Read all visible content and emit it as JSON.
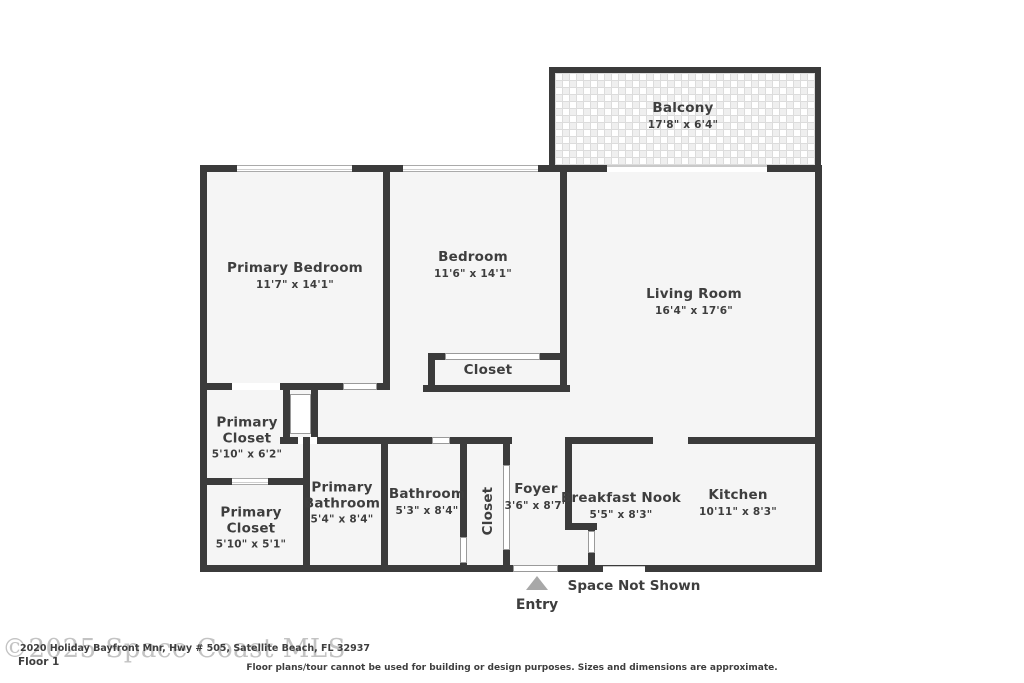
{
  "floorplan": {
    "rooms": [
      {
        "name": "Balcony",
        "dims": "17'8\" x 6'4\""
      },
      {
        "name": "Primary Bedroom",
        "dims": "11'7\" x 14'1\""
      },
      {
        "name": "Bedroom",
        "dims": "11'6\" x 14'1\""
      },
      {
        "name": "Living Room",
        "dims": "16'4\" x 17'6\""
      },
      {
        "name": "Closet",
        "dims": ""
      },
      {
        "name": "Primary Closet",
        "dims": "5'10\" x 6'2\""
      },
      {
        "name": "Primary Closet",
        "dims": "5'10\" x 5'1\""
      },
      {
        "name": "Primary Bathroom",
        "dims": "5'4\" x 8'4\""
      },
      {
        "name": "Bathroom",
        "dims": "5'3\" x 8'4\""
      },
      {
        "name": "Closet",
        "dims": ""
      },
      {
        "name": "Foyer",
        "dims": "3'6\" x 8'7\""
      },
      {
        "name": "Breakfast Nook",
        "dims": "5'5\" x 8'3\""
      },
      {
        "name": "Kitchen",
        "dims": "10'11\" x 8'3\""
      }
    ],
    "annotations": {
      "space_not_shown": "Space Not Shown",
      "entry": "Entry"
    },
    "footer": {
      "watermark": "©2025 Space Coast MLS",
      "address": "2020 Holiday Bayfront Mnr, Hwy # 505, Satellite Beach, FL 32937",
      "floor_label": "Floor 1",
      "disclaimer": "Floor plans/tour cannot be used for building or design purposes. Sizes and dimensions are approximate."
    },
    "colors": {
      "wall": "#3b3b3b",
      "room_fill": "#f5f5f5",
      "text": "#3e3e3e",
      "entry_arrow": "#a8a8a8",
      "watermark": "#c3c3c3"
    }
  }
}
